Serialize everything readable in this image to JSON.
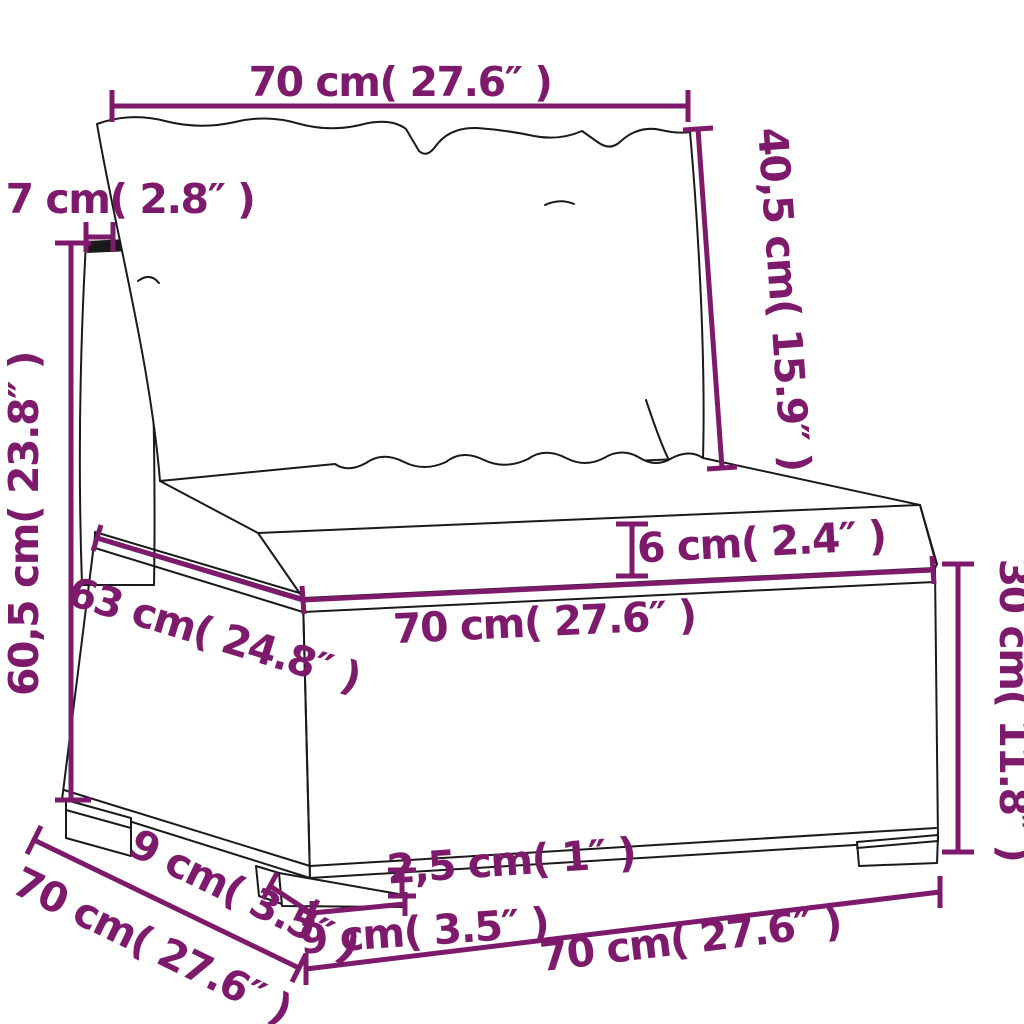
{
  "style": {
    "accent": "#7D1A6B",
    "ink": "#1A1A1A",
    "background": "#FFFFFF"
  },
  "dims": {
    "back_width": {
      "label": "70 cm( 27.6″ )"
    },
    "back_height": {
      "label": "40,5 cm( 15.9″ )"
    },
    "frame_width": {
      "label": "7 cm( 2.8″ )"
    },
    "total_height": {
      "label": "60,5 cm( 23.8″ )"
    },
    "seat_depth": {
      "label": "63 cm( 24.8″ )"
    },
    "seat_width": {
      "label": "70 cm( 27.6″ )"
    },
    "cushion_thickness": {
      "label": "6 cm( 2.4″ )"
    },
    "base_height": {
      "label": "30 cm( 11.8″ )"
    },
    "overall_depth": {
      "label": "70 cm( 27.6″ )"
    },
    "leg_depth": {
      "label": "9 cm( 3.5″ )"
    },
    "leg_width": {
      "label": "9 cm( 3.5″ )"
    },
    "leg_height": {
      "label": "2,5 cm( 1″ )"
    },
    "overall_width": {
      "label": "70 cm( 27.6″ )"
    }
  }
}
